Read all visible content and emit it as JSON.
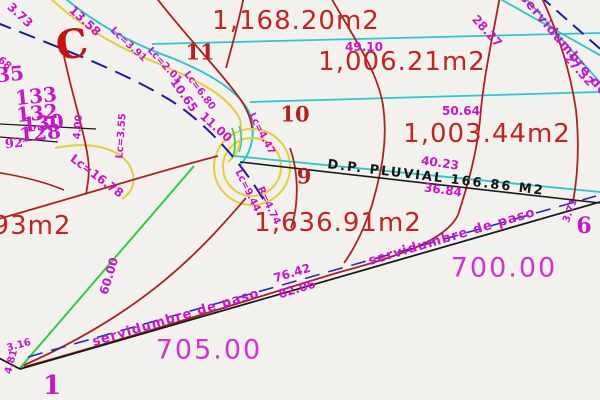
{
  "drawing": {
    "type": "cadastral-plat",
    "colors": {
      "background": "#f2f1ee",
      "parcel_red": "#a92323",
      "area_text_red": "#c02525",
      "dimension_magenta": "#c716c7",
      "road_cyan": "#2bc7cb",
      "road_yellow": "#e2ce3e",
      "survey_green": "#2ecc45",
      "pipe_navy": "#1d1d96",
      "boundary_black": "#1b1b1b",
      "easement_blue": "#2a2ab8"
    }
  },
  "labels": [
    {
      "name": "area-1168",
      "text": "1,168.20m2",
      "x": 296,
      "y": 21,
      "rot": 0,
      "cls": "area"
    },
    {
      "name": "area-1006",
      "text": "1,006.21m2",
      "x": 402,
      "y": 62,
      "rot": 0,
      "cls": "area"
    },
    {
      "name": "area-1003",
      "text": "1,003.44m2",
      "x": 487,
      "y": 134,
      "rot": 0,
      "cls": "area"
    },
    {
      "name": "area-1636",
      "text": "1,636.91m2",
      "x": 338,
      "y": 223,
      "rot": 0,
      "cls": "area"
    },
    {
      "name": "area-93",
      "text": "93m2",
      "x": 32,
      "y": 226,
      "rot": 0,
      "cls": "area"
    },
    {
      "name": "elevation-705",
      "text": "705.00",
      "x": 209,
      "y": 350,
      "rot": 0,
      "cls": "elev"
    },
    {
      "name": "elevation-700",
      "text": "700.00",
      "x": 504,
      "y": 268,
      "rot": 0,
      "cls": "elev"
    },
    {
      "name": "lot-number-11",
      "text": "11",
      "x": 200,
      "y": 52,
      "rot": 0,
      "cls": "lot"
    },
    {
      "name": "lot-number-10",
      "text": "10",
      "x": 295,
      "y": 114,
      "rot": 0,
      "cls": "lot"
    },
    {
      "name": "lot-number-9",
      "text": "9",
      "x": 304,
      "y": 176,
      "rot": 0,
      "cls": "lot"
    },
    {
      "name": "corner-number-1",
      "text": "1",
      "x": 52,
      "y": 386,
      "rot": 0,
      "cls": "corner"
    },
    {
      "name": "corner-number-6",
      "text": "6",
      "x": 584,
      "y": 226,
      "rot": 0,
      "cls": "corner",
      "size": 22
    },
    {
      "name": "street-letter-c",
      "text": "C",
      "x": 72,
      "y": 45,
      "rot": -8,
      "cls": "cletter"
    },
    {
      "name": "block-number-35",
      "text": "35",
      "x": 10,
      "y": 74,
      "rot": -6,
      "cls": "corner",
      "size": 20
    },
    {
      "name": "block-number-133",
      "text": "133",
      "x": 36,
      "y": 96,
      "rot": -6,
      "cls": "corner",
      "size": 20
    },
    {
      "name": "block-number-132",
      "text": "132",
      "x": 37,
      "y": 113,
      "rot": -6,
      "cls": "corner",
      "size": 20
    },
    {
      "name": "block-number-130",
      "text": "130",
      "x": 43,
      "y": 123,
      "rot": -6,
      "cls": "corner",
      "size": 20
    },
    {
      "name": "block-number-128",
      "text": "128",
      "x": 40,
      "y": 133,
      "rot": -6,
      "cls": "corner",
      "size": 20
    },
    {
      "name": "block-number-92",
      "text": "92",
      "x": 14,
      "y": 144,
      "rot": -6,
      "cls": "corner",
      "size": 13
    },
    {
      "name": "dim-68",
      "text": "68",
      "x": 4,
      "y": 64,
      "rot": 40,
      "cls": "dim sm"
    },
    {
      "name": "dim-3-73",
      "text": "3.73",
      "x": 20,
      "y": 15,
      "rot": 43,
      "cls": "dim"
    },
    {
      "name": "dim-13-58",
      "text": "13.58",
      "x": 85,
      "y": 21,
      "rot": 43,
      "cls": "dim"
    },
    {
      "name": "dim-49-10",
      "text": "49.10",
      "x": 364,
      "y": 47,
      "rot": 0,
      "cls": "dim"
    },
    {
      "name": "dim-50-64",
      "text": "50.64",
      "x": 461,
      "y": 111,
      "rot": 0,
      "cls": "dim"
    },
    {
      "name": "dim-40-23",
      "text": "40.23",
      "x": 440,
      "y": 163,
      "rot": 8,
      "cls": "dim"
    },
    {
      "name": "dim-36-84",
      "text": "36.84",
      "x": 443,
      "y": 190,
      "rot": 8,
      "cls": "dim"
    },
    {
      "name": "dim-28-27",
      "text": "28.27",
      "x": 487,
      "y": 31,
      "rot": 48,
      "cls": "dim"
    },
    {
      "name": "dim-27-32",
      "text": "27.32",
      "x": 579,
      "y": 70,
      "rot": 48,
      "cls": "dim"
    },
    {
      "name": "dim-76-42",
      "text": "76.42",
      "x": 292,
      "y": 273,
      "rot": -17,
      "cls": "dim"
    },
    {
      "name": "dim-82-06",
      "text": "82.06",
      "x": 297,
      "y": 289,
      "rot": -17,
      "cls": "dim"
    },
    {
      "name": "dim-60-00",
      "text": "60.00",
      "x": 109,
      "y": 276,
      "rot": -73,
      "cls": "dim"
    },
    {
      "name": "dim-3-16",
      "text": "3.16",
      "x": 19,
      "y": 346,
      "rot": -15,
      "cls": "dim sm"
    },
    {
      "name": "dim-4-81",
      "text": "4.81",
      "x": 12,
      "y": 362,
      "rot": -75,
      "cls": "dim sm"
    },
    {
      "name": "dim-3-71",
      "text": "3.71",
      "x": 571,
      "y": 211,
      "rot": -70,
      "cls": "dim sm"
    },
    {
      "name": "dim-10-65",
      "text": "10.65",
      "x": 184,
      "y": 95,
      "rot": 55,
      "cls": "dim"
    },
    {
      "name": "dim-11-00",
      "text": "11.00",
      "x": 216,
      "y": 127,
      "rot": 42,
      "cls": "dim"
    },
    {
      "name": "dim-4-00",
      "text": "4.00",
      "x": 79,
      "y": 127,
      "rot": -85,
      "cls": "dim sm"
    },
    {
      "name": "curve-lc-3-91",
      "text": "Lc=3.91",
      "x": 128,
      "y": 45,
      "rot": 43,
      "cls": "dim sm"
    },
    {
      "name": "curve-lc-2-01",
      "text": "Lc=2.01",
      "x": 164,
      "y": 66,
      "rot": 47,
      "cls": "dim sm"
    },
    {
      "name": "curve-lc-6-80",
      "text": "Lc=6.80",
      "x": 199,
      "y": 91,
      "rot": 53,
      "cls": "dim sm"
    },
    {
      "name": "curve-lc-4-47",
      "text": "Lc=4.47",
      "x": 261,
      "y": 134,
      "rot": 62,
      "cls": "dim sm"
    },
    {
      "name": "curve-lc-9-44",
      "text": "Lc=9.44",
      "x": 247,
      "y": 191,
      "rot": 64,
      "cls": "dim sm"
    },
    {
      "name": "curve-r-4-74",
      "text": "R=4.74",
      "x": 268,
      "y": 206,
      "rot": 64,
      "cls": "dim sm"
    },
    {
      "name": "curve-lc-3-55",
      "text": "Lc=3.55",
      "x": 122,
      "y": 136,
      "rot": -86,
      "cls": "dim sm"
    },
    {
      "name": "curve-lc-16-78",
      "text": "Lc=16.78",
      "x": 97,
      "y": 176,
      "rot": 37,
      "cls": "dim"
    },
    {
      "name": "note-dp-pluvial",
      "text": "D.P.  PLUVIAL  166.86  M2",
      "x": 436,
      "y": 178,
      "rot": 7,
      "cls": "note"
    },
    {
      "name": "easement-servidumbre-left",
      "text": "servidumbre  de  paso",
      "x": 176,
      "y": 318,
      "rot": -16.5,
      "cls": "serv"
    },
    {
      "name": "easement-servidumbre-right",
      "text": "servidumbre  de  paso",
      "x": 452,
      "y": 237,
      "rot": -16.5,
      "cls": "serv"
    },
    {
      "name": "easement-servidumbre-topright",
      "text": "servidumbre  de  paso",
      "x": 578,
      "y": 62,
      "rot": 50,
      "cls": "serv"
    }
  ]
}
